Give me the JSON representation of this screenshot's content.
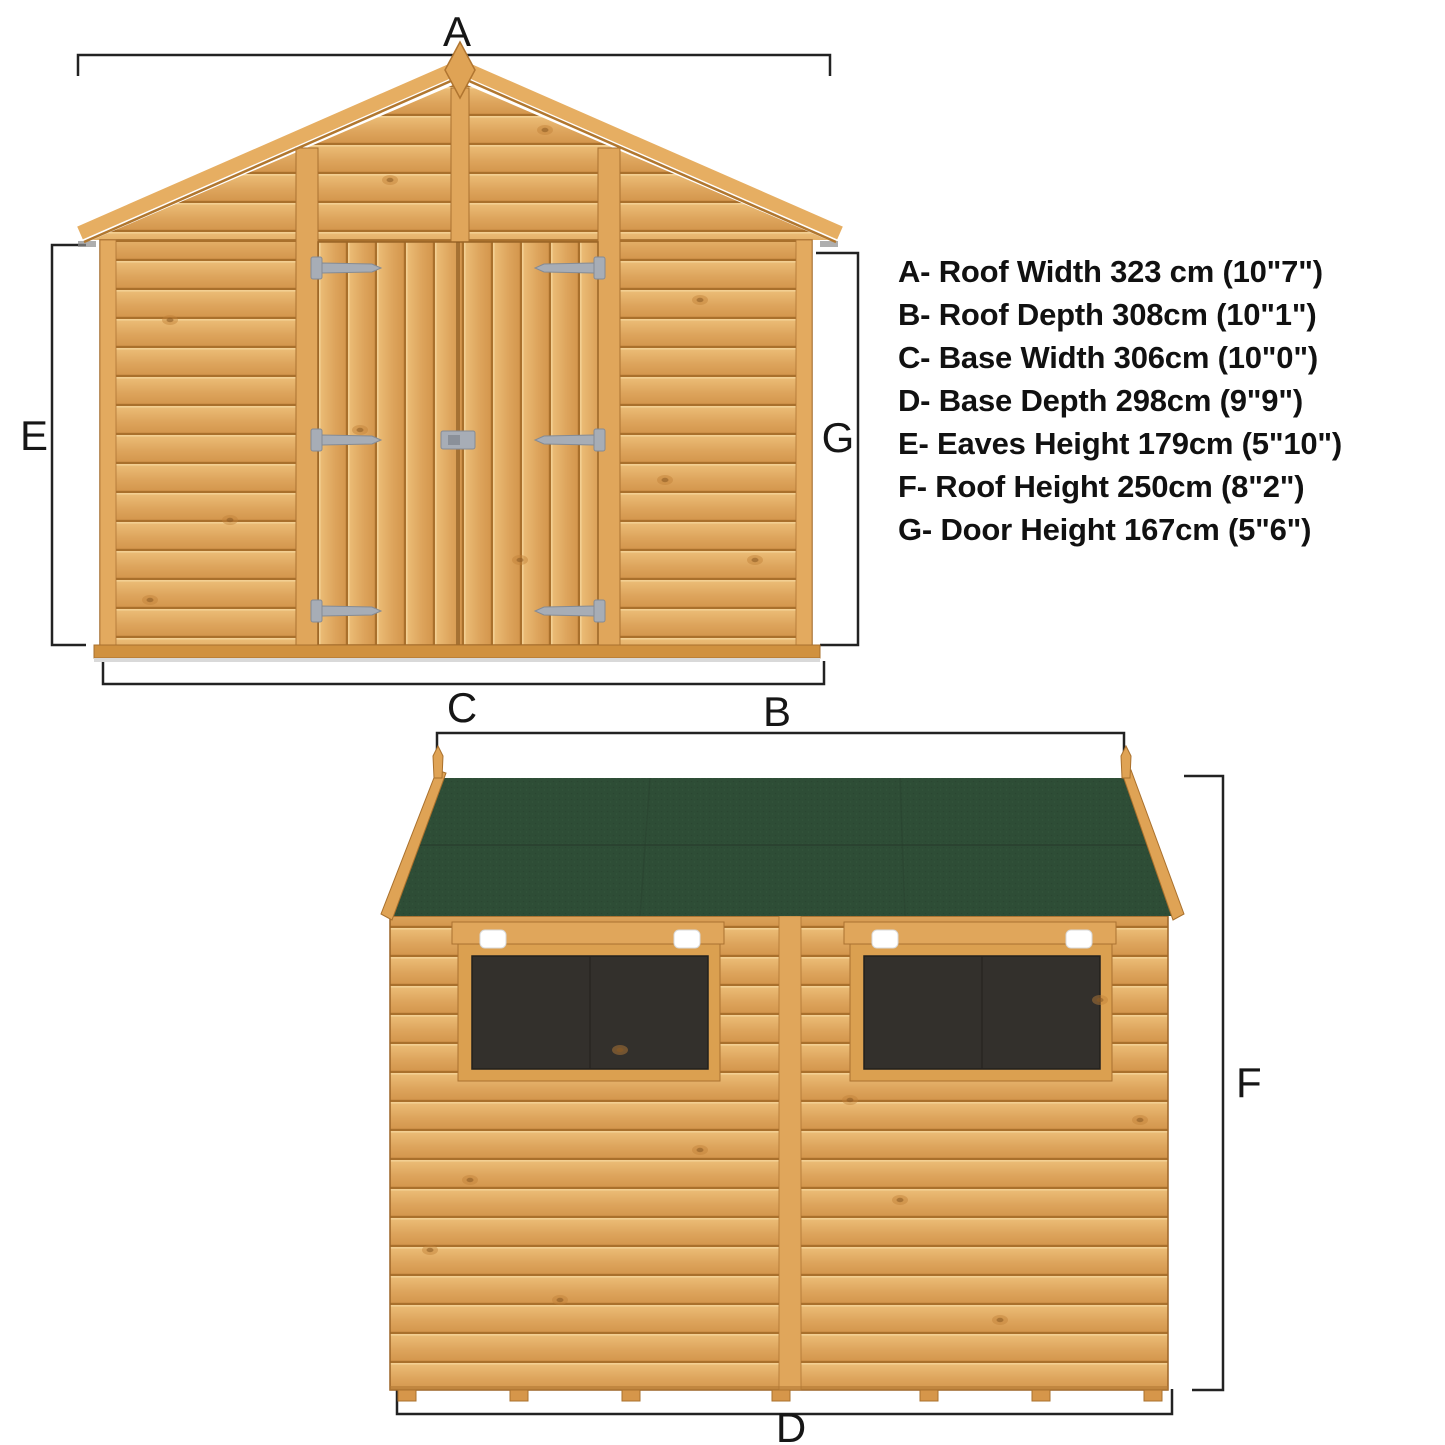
{
  "diagram": {
    "type": "shed-dimension-diagram",
    "background": "#ffffff",
    "dimension_labels": {
      "roof_width": "A",
      "roof_depth": "B",
      "base_width": "C",
      "base_depth": "D",
      "eaves_height": "E",
      "roof_height": "F",
      "door_height": "G"
    },
    "specs": {
      "items": [
        "A- Roof Width 323 cm (10\"7\")",
        "B- Roof Depth 308cm (10\"1\")",
        "C- Base Width 306cm (10\"0\")",
        "D- Base Depth 298cm (9\"9\")",
        "E- Eaves Height 179cm (5\"10\")",
        "F- Roof Height 250cm (8\"2\")",
        "G- Door Height 167cm (5\"6\")"
      ]
    },
    "colors": {
      "wood_mid": "#dda45c",
      "wood_dark_line": "#a9702c",
      "wood_highlight": "#f3cf92",
      "trim": "#e0a65b",
      "roof_green": "#2e4d36",
      "glazing": "#33302c",
      "hinge_gray": "#a7adb6",
      "clip_white": "#ffffff",
      "dimension_line": "#222222",
      "label_text": "#111111"
    }
  }
}
